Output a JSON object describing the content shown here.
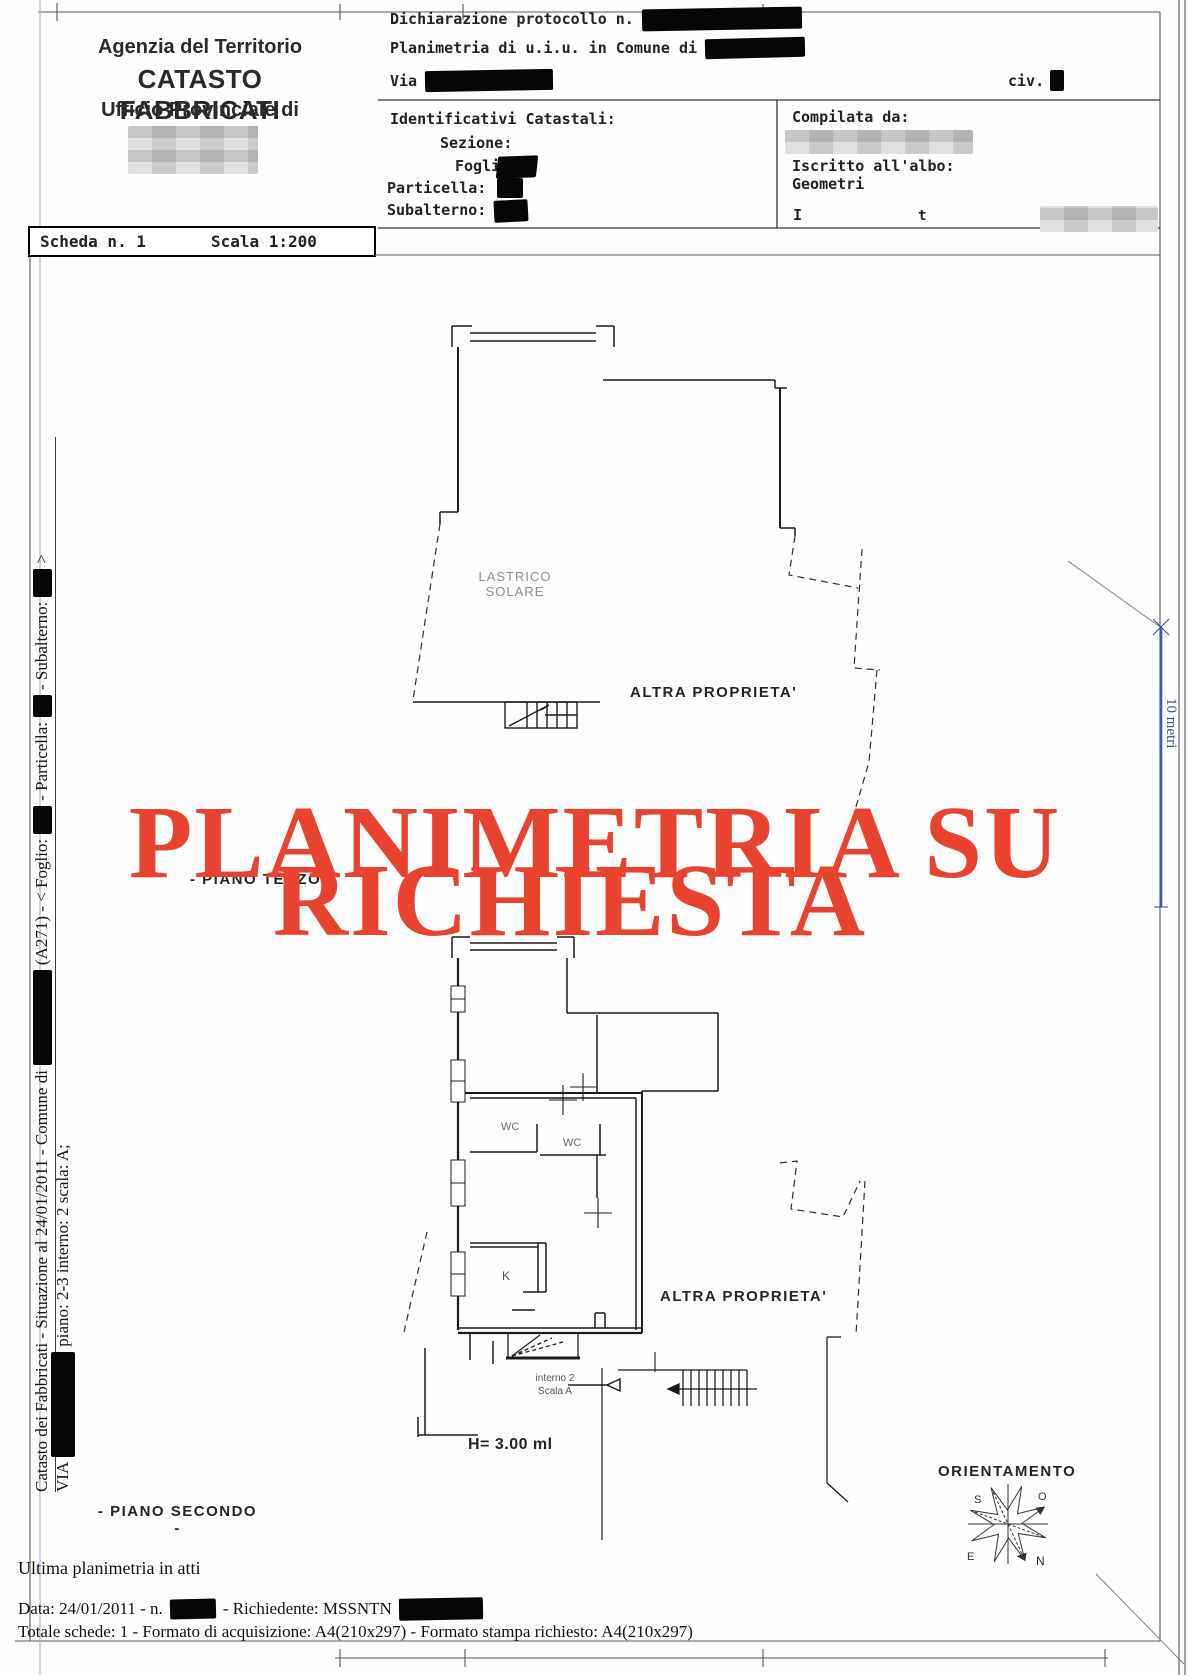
{
  "header": {
    "agency": "Agenzia del Territorio",
    "registry": "CATASTO FABBRICATI",
    "office": "Ufficio Provinciale di",
    "declaration_label": "Dichiarazione protocollo n.",
    "planimetria_label": "Planimetria di u.i.u. in Comune di",
    "via_label": "Via",
    "civ_label": "civ.",
    "identificativi_title": "Identificativi Catastali:",
    "sezione_label": "Sezione:",
    "foglio_label": "Foglio:",
    "particella_label": "Particella:",
    "subalterno_label": "Subalterno:",
    "compilata_label": "Compilata da:",
    "albo_label": "Iscritto all'albo:",
    "albo_value": "Geometri",
    "firma_left": "I",
    "firma_right": "t"
  },
  "scheda": {
    "number": "Scheda n. 1",
    "scale": "Scala 1:200"
  },
  "sidebar": {
    "line1_seg1": "Catasto dei Fabbricati - Situazione al 24/01/2011 - Comune di",
    "line1_seg2": "(A271) - < Foglio:",
    "line1_seg3": "- Particella:",
    "line1_seg4": "- Subalterno:",
    "line1_seg5": ">",
    "line2_seg1": "VIA",
    "line2_seg2": "piano: 2-3 interno: 2 scala: A;"
  },
  "plan": {
    "watermark_line1": "PLANIMETRIA SU",
    "watermark_line2": "RICHIESTA",
    "lastrico_label": "LASTRICO SOLARE",
    "altra_proprieta_top": "ALTRA PROPRIETA'",
    "altra_proprieta_bottom": "ALTRA PROPRIETA'",
    "piano_terzo_label": "- PIANO TERZO -",
    "piano_secondo_label": "- PIANO SECONDO -",
    "wc1_label": "WC",
    "wc2_label": "WC",
    "kitchen_label": "K",
    "interno_label": "interno 2",
    "scala_label": "Scala A",
    "height_label": "H= 3.00 ml",
    "orientamento_label": "ORIENTAMENTO",
    "compass": {
      "n": "N",
      "s": "S",
      "e": "E",
      "o": "O"
    },
    "scalebar_label": "10 metri"
  },
  "footer": {
    "ultima_note": "Ultima planimetria in atti",
    "data_seg1": "Data: 24/01/2011 - n.",
    "data_seg2": "- Richiedente: MSSNTN",
    "totale_line": "Totale schede: 1 - Formato di acquisizione: A4(210x297)  - Formato stampa richiesto: A4(210x297)"
  },
  "colors": {
    "watermark_red": "#e8432f",
    "scalebar_blue": "#3b5fa0",
    "guide_blue": "#a6b7d4"
  }
}
